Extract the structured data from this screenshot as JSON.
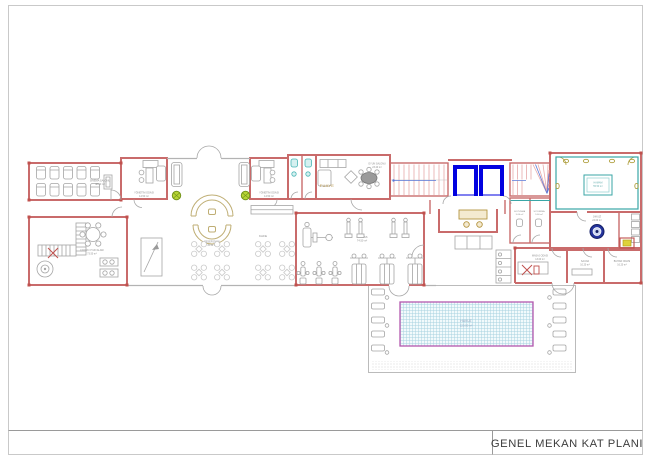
{
  "title_block": {
    "title": "GENEL MEKAN KAT PLANI"
  },
  "rooms": {
    "cinema": {
      "label": "SİNEMA SALONU",
      "area": "48.50 m²"
    },
    "office_left": {
      "label": "YÖNETİM ODASI",
      "area": "14.50 m²"
    },
    "office_right": {
      "label": "YÖNETİM ODASI",
      "area": "14.50 m²"
    },
    "foyer": {
      "label": "FUAYE"
    },
    "game_room": {
      "label": "OYUN SALONU",
      "area": "23.20 m²"
    },
    "reception": {
      "label": "RESEPSİYON",
      "area": "45.50 m²"
    },
    "cafe": {
      "label": "KAFE"
    },
    "kids": {
      "label": "ÇOCUK OYUN ALANI",
      "area": "73.50 m²"
    },
    "fitness": {
      "label": "FİTNESS",
      "area": "74.50 m²"
    },
    "hamam": {
      "label": "HAMAM",
      "area": "55.50 m²"
    },
    "jacuzzi": {
      "label": "JAKUZİ",
      "area": "24.00 m²"
    },
    "changing_left": {
      "label": "SOYUNMA",
      "area": "5.60 m²"
    },
    "changing_right": {
      "label": "SOYUNMA",
      "area": "5.60 m²"
    },
    "massage": {
      "label": "MASAJ ODASI",
      "area": "13.00 m²"
    },
    "sauna": {
      "label": "SAUNA",
      "area": "10.20 m²"
    },
    "steam": {
      "label": "BUHAR ODASI",
      "area": "16.20 m²"
    },
    "pool": {
      "label": "HAVUZ",
      "area": "120.00 m²"
    }
  },
  "colors": {
    "wall_red": "#c96b6b",
    "elevator_blue": "#0202e0",
    "hamam_teal": "#3aa6a6",
    "pool_border": "#b457ae",
    "desk_tan": "#bfae74",
    "plant_green": "#b6d433",
    "jacuzzi_navy": "#24349c",
    "accent_red": "#c0504d"
  }
}
